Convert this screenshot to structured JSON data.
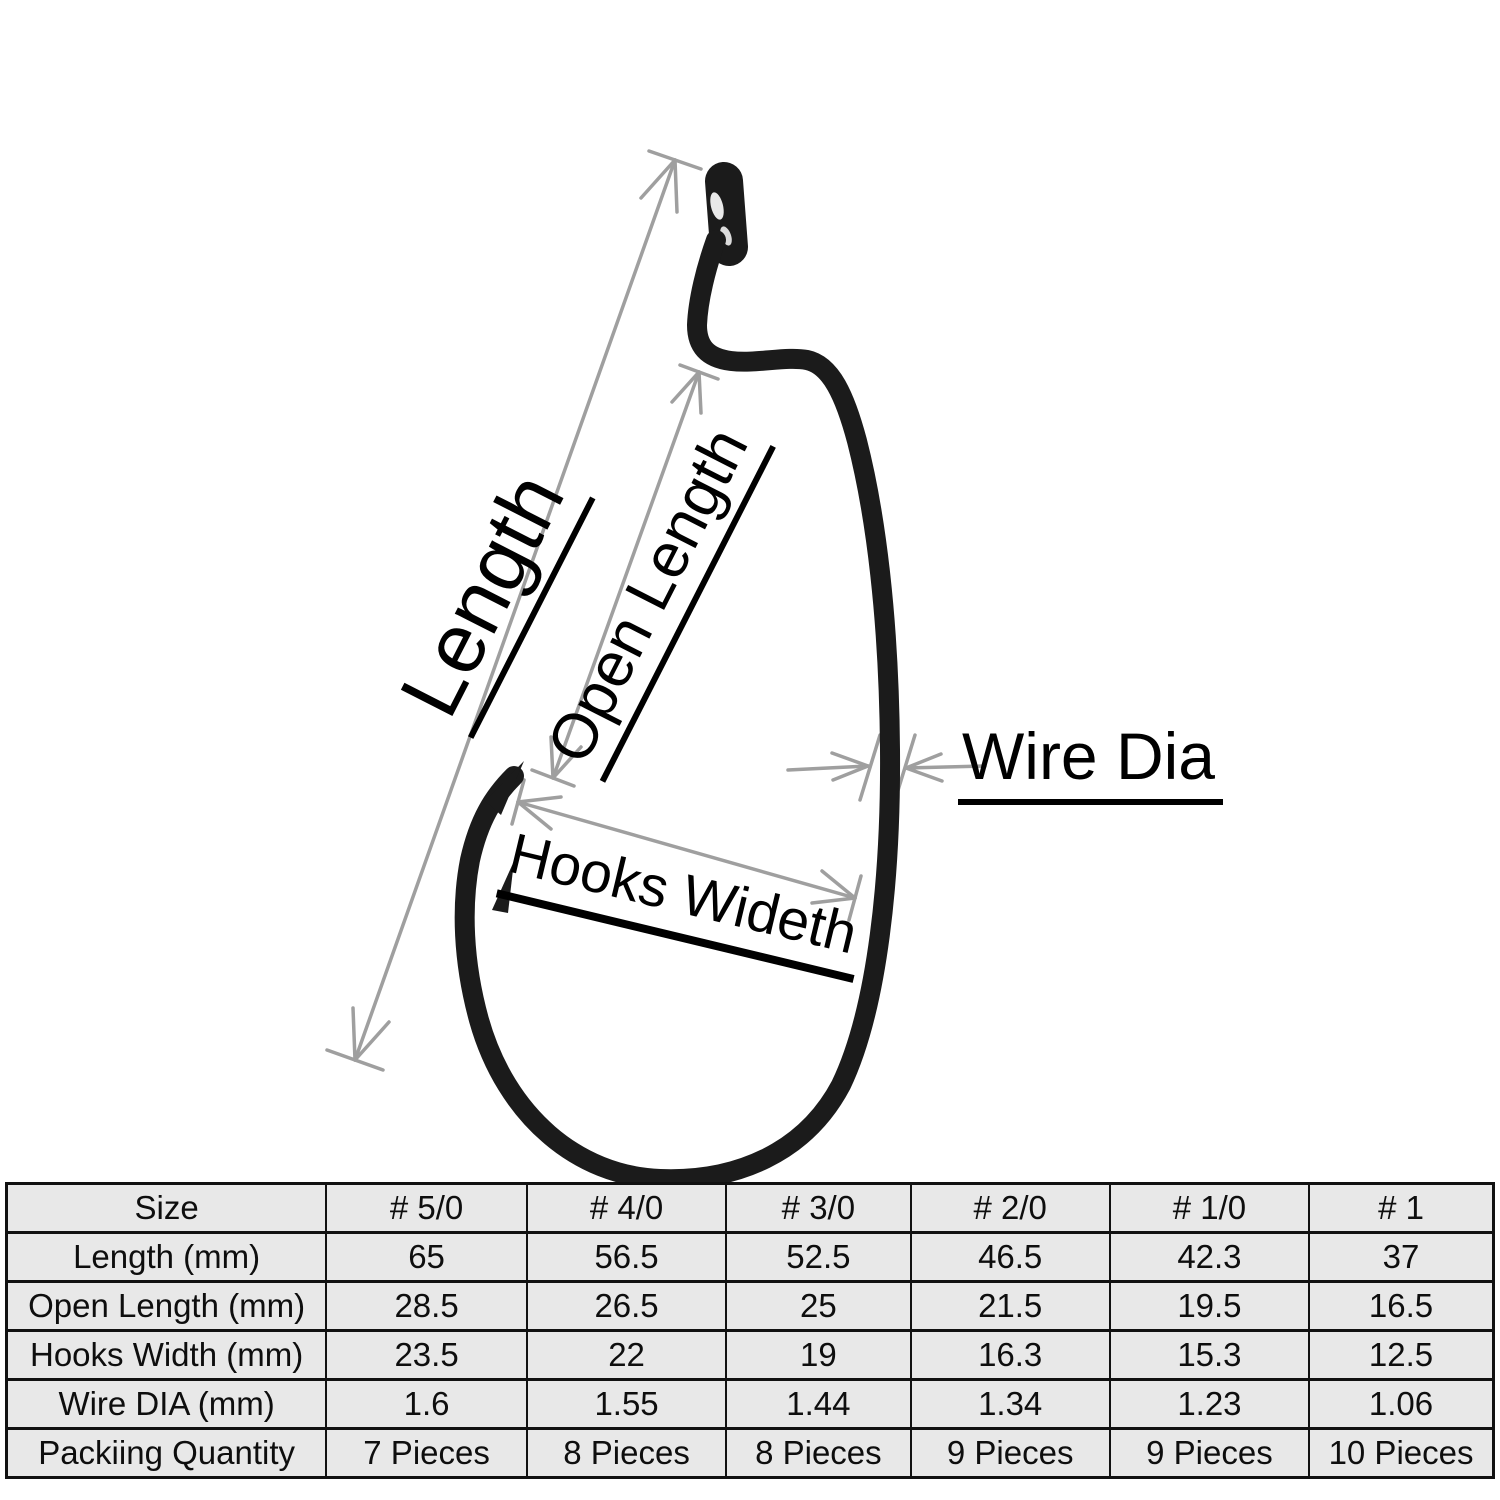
{
  "diagram": {
    "labels": {
      "length": "Length",
      "open_length": "Open Length",
      "wire_dia": "Wire Dia",
      "hooks_width": "Hooks Wideth"
    },
    "colors": {
      "arrow": "#9f9f9f",
      "hook": "#1b1b1b",
      "label_text": "#000000"
    }
  },
  "table": {
    "cell_bg": "#e8e8e8",
    "border_color": "#111111",
    "header": [
      "Size",
      "# 5/0",
      "# 4/0",
      "# 3/0",
      "# 2/0",
      "# 1/0",
      "# 1"
    ],
    "rows": [
      {
        "label": "Length (mm)",
        "values": [
          "65",
          "56.5",
          "52.5",
          "46.5",
          "42.3",
          "37"
        ]
      },
      {
        "label": "Open Length (mm)",
        "values": [
          "28.5",
          "26.5",
          "25",
          "21.5",
          "19.5",
          "16.5"
        ]
      },
      {
        "label": "Hooks Width (mm)",
        "values": [
          "23.5",
          "22",
          "19",
          "16.3",
          "15.3",
          "12.5"
        ]
      },
      {
        "label": "Wire DIA (mm)",
        "values": [
          "1.6",
          "1.55",
          "1.44",
          "1.34",
          "1.23",
          "1.06"
        ]
      },
      {
        "label": "Packiing Quantity",
        "values": [
          "7 Pieces",
          "8 Pieces",
          "8 Pieces",
          "9 Pieces",
          "9 Pieces",
          "10 Pieces"
        ]
      }
    ]
  }
}
